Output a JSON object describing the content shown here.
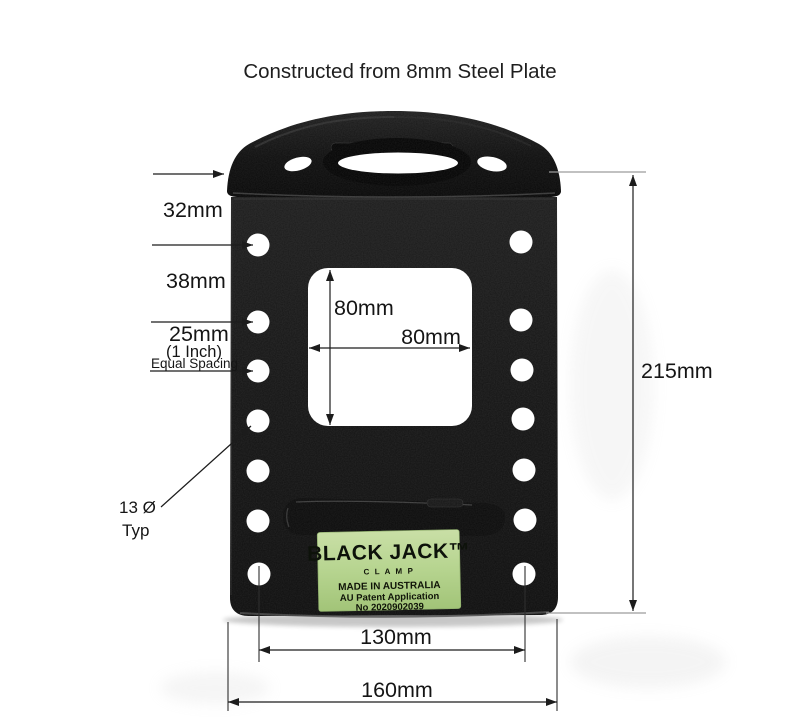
{
  "title": "Constructed from 8mm Steel Plate",
  "label": {
    "brand": "BLACK JACK™",
    "clamp": "C L A M P",
    "made_in": "MADE IN AUSTRALIA",
    "patent": "AU Patent Application",
    "patent_no": "No 2020902039",
    "bg_color": "#b6d48f"
  },
  "dims": {
    "top_offset": "32mm",
    "first_gap": "38mm",
    "spacing": "25mm",
    "spacing_inch": "(1 Inch)",
    "spacing_note": "Equal Spacing",
    "hole_dia": "13 Ø",
    "hole_dia_note": "Typ",
    "cutout_height": "80mm",
    "cutout_width": "80mm",
    "height": "215mm",
    "hole_span": "130mm",
    "width": "160mm"
  },
  "colors": {
    "background": "#ffffff",
    "steel_black": "#131313",
    "annotation": "#1c1c1c",
    "extension_gray": "#9c9c9c",
    "label_green": "#b6d48f"
  }
}
